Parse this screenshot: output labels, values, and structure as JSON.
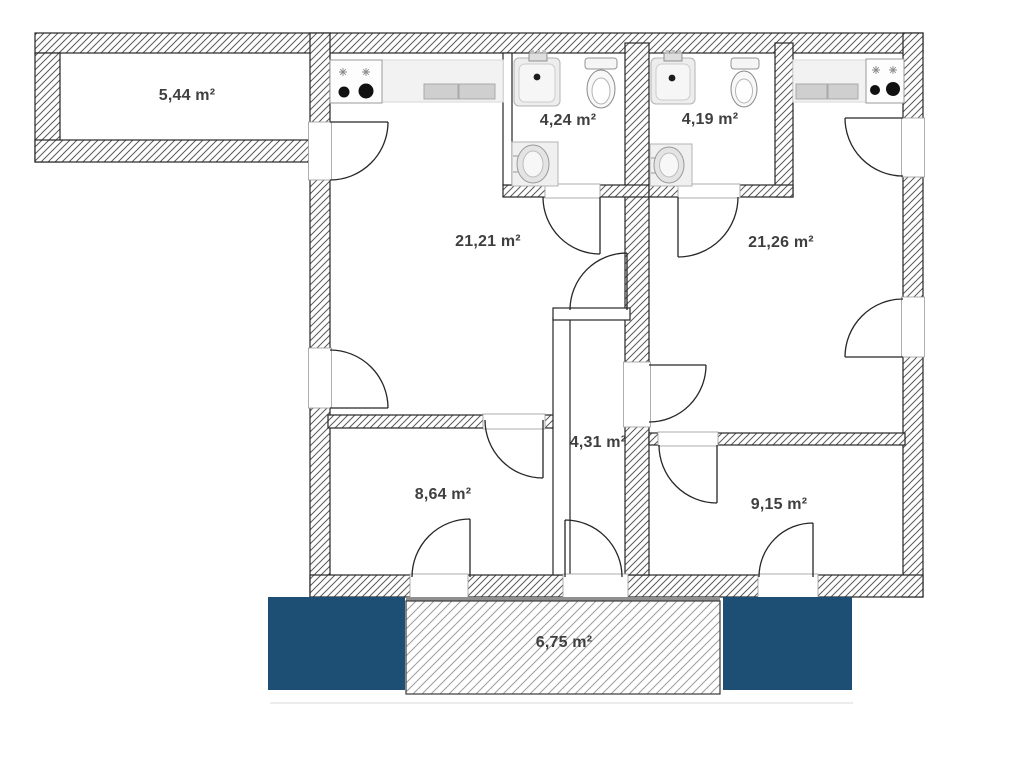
{
  "meta": {
    "title": "Apartment floor plan",
    "unit_suffix": "m²"
  },
  "colors": {
    "accent_blue": "#1d4e73",
    "wall_stroke": "#262626",
    "hatch_line": "#5a5a5a",
    "balcony_hatch_line": "#9d9d9d",
    "label_text": "#3f3f3f"
  },
  "rooms": [
    {
      "id": "balcony-top",
      "name": "top balcony",
      "label": "5,44 m²"
    },
    {
      "id": "room-left",
      "name": "left living room",
      "label": "21,21 m²"
    },
    {
      "id": "bath-left",
      "name": "left bathroom",
      "label": "4,24 m²"
    },
    {
      "id": "bath-right",
      "name": "right bathroom",
      "label": "4,19 m²"
    },
    {
      "id": "room-right",
      "name": "right living room",
      "label": "21,26 m²"
    },
    {
      "id": "hallway",
      "name": "hallway",
      "label": "4,31 m²"
    },
    {
      "id": "room-bottom-left",
      "name": "bottom left room",
      "label": "8,64 m²"
    },
    {
      "id": "room-bottom-right",
      "name": "bottom right room",
      "label": "9,15 m²"
    },
    {
      "id": "balcony-bottom",
      "name": "bottom balcony",
      "label": "6,75 m²"
    }
  ],
  "fixtures": [
    "stove-left",
    "kitchen-counter-left",
    "kitchen-sink-left",
    "stove-right",
    "kitchen-counter-right",
    "kitchen-sink-right",
    "bath-sink-left",
    "toilet-left",
    "washing-machine-left",
    "bath-sink-right",
    "toilet-right",
    "washing-machine-right"
  ]
}
